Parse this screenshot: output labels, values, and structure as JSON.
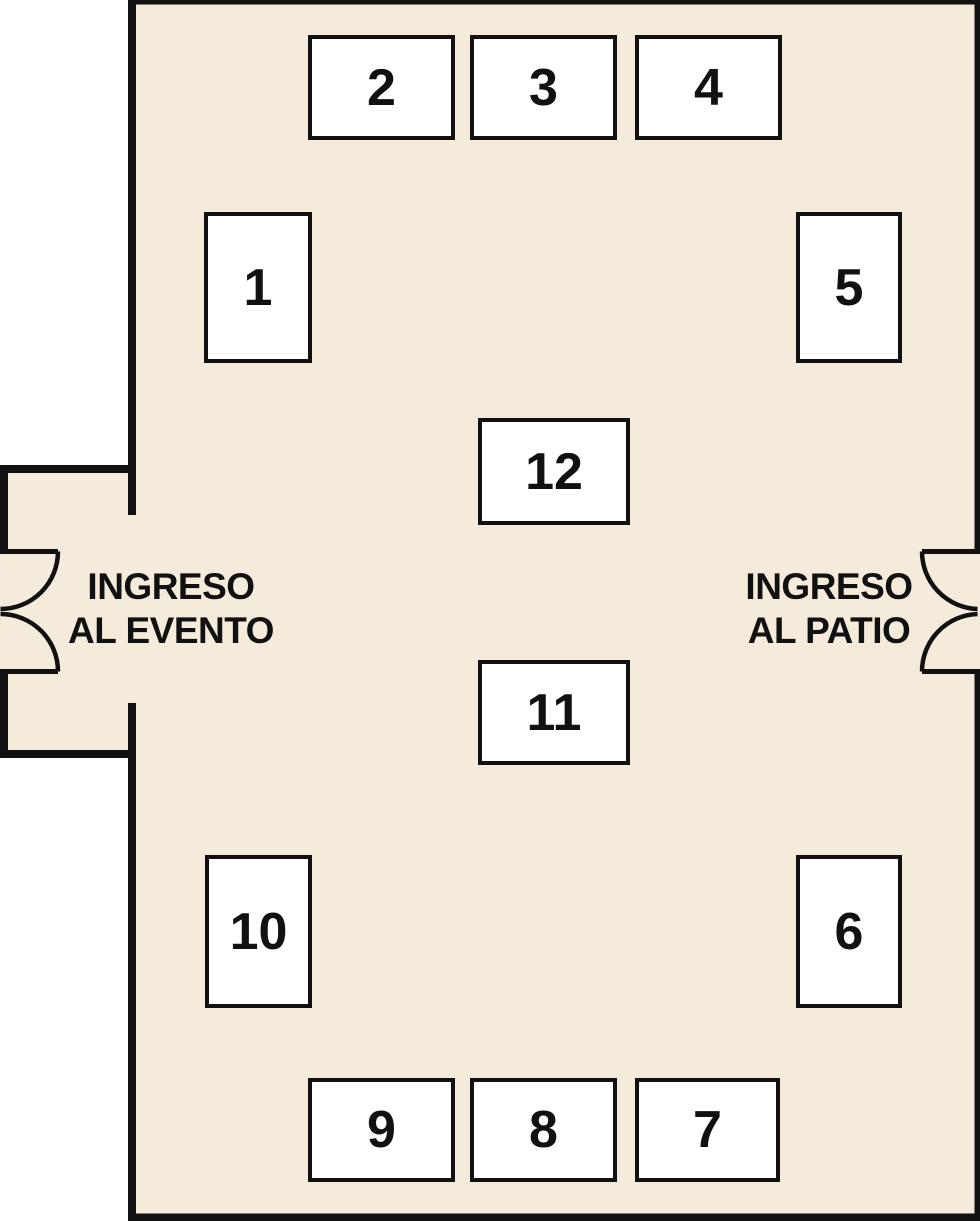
{
  "colors": {
    "floor": "#f4ebdb",
    "wall": "#111111",
    "booth_fill": "#ffffff",
    "text": "#111111"
  },
  "entrances": {
    "left": {
      "line1": "INGRESO",
      "line2": "AL EVENTO"
    },
    "right": {
      "line1": "INGRESO",
      "line2": "AL PATIO"
    }
  },
  "booths": [
    {
      "label": "1"
    },
    {
      "label": "2"
    },
    {
      "label": "3"
    },
    {
      "label": "4"
    },
    {
      "label": "5"
    },
    {
      "label": "6"
    },
    {
      "label": "7"
    },
    {
      "label": "8"
    },
    {
      "label": "9"
    },
    {
      "label": "10"
    },
    {
      "label": "11"
    },
    {
      "label": "12"
    }
  ]
}
